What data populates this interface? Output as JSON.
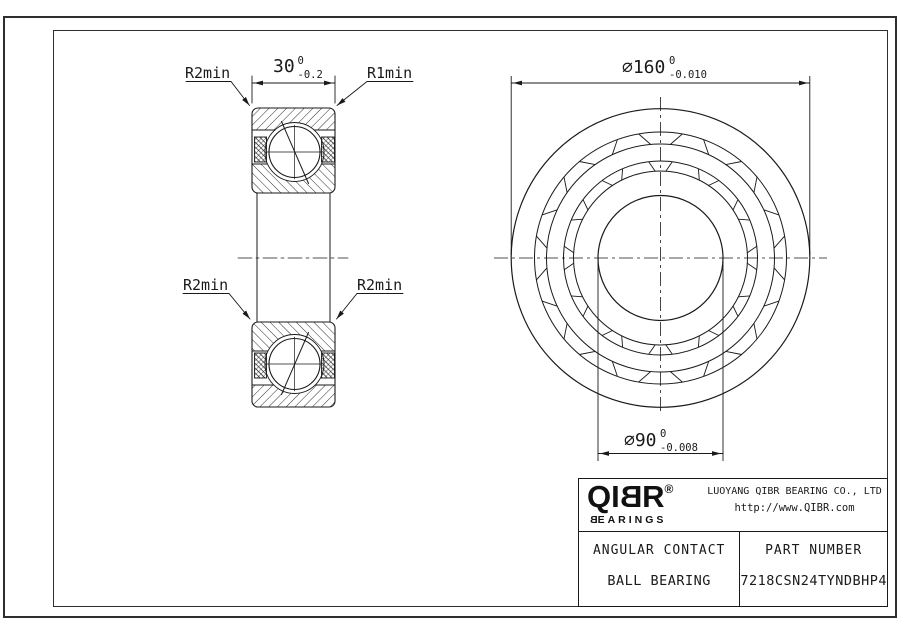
{
  "colors": {
    "line": "#1a1a1a",
    "background": "#ffffff"
  },
  "section_view": {
    "dim_width": {
      "main": "30",
      "sup": "0",
      "sub": "-0.2"
    },
    "label_top_left": "R2min",
    "label_top_right": "R1min",
    "label_bottom_left": "R2min",
    "label_bottom_right": "R2min"
  },
  "front_view": {
    "dim_outer": {
      "main": "⌀160",
      "sup": "0",
      "sub": "-0.010"
    },
    "dim_bore": {
      "main": "⌀90",
      "sup": "0",
      "sub": "-0.008"
    }
  },
  "title_block": {
    "logo": {
      "l1": "Q",
      "l2": "I",
      "l3": "B",
      "l4": "R",
      "registered": "®",
      "sub_first": "B",
      "sub_rest": "EARINGS"
    },
    "company": "LUOYANG QIBR BEARING CO., LTD",
    "website": "http://www.QIBR.com",
    "product_line1": "ANGULAR CONTACT",
    "product_line2": "BALL BEARING",
    "part_number_label": "PART NUMBER",
    "part_number": "7218CSN24TYNDBHP4"
  }
}
